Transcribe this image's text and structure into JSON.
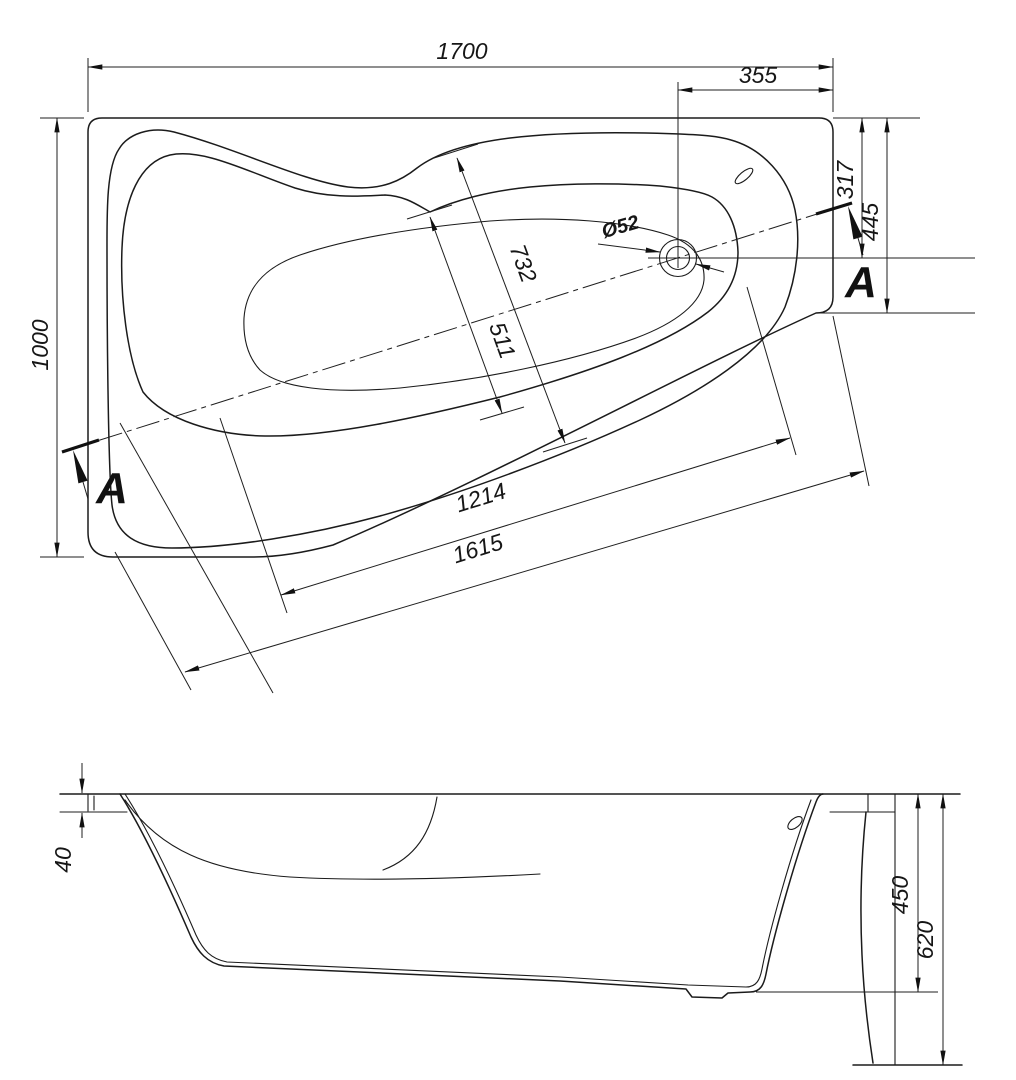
{
  "drawing": {
    "type": "bathtub-technical-drawing",
    "views": [
      "top-view",
      "side-view"
    ],
    "line_color": "#1b1b1b",
    "background_color": "#ffffff"
  },
  "top_view": {
    "dim_overall_length": "1700",
    "dim_drain_to_edge": "355",
    "dim_overall_width": "1000",
    "dim_edge_to_drain_axis": "317",
    "dim_right_end_width": "445",
    "dim_cross_outer": "732",
    "dim_cross_inner": "511",
    "dim_basin_length": "1214",
    "dim_diagonal_length": "1615",
    "drain_diameter": "Ø52",
    "section_label_left": "A",
    "section_label_right": "A"
  },
  "side_view": {
    "dim_rim_height": "40",
    "dim_inner_depth": "450",
    "dim_overall_height": "620"
  }
}
